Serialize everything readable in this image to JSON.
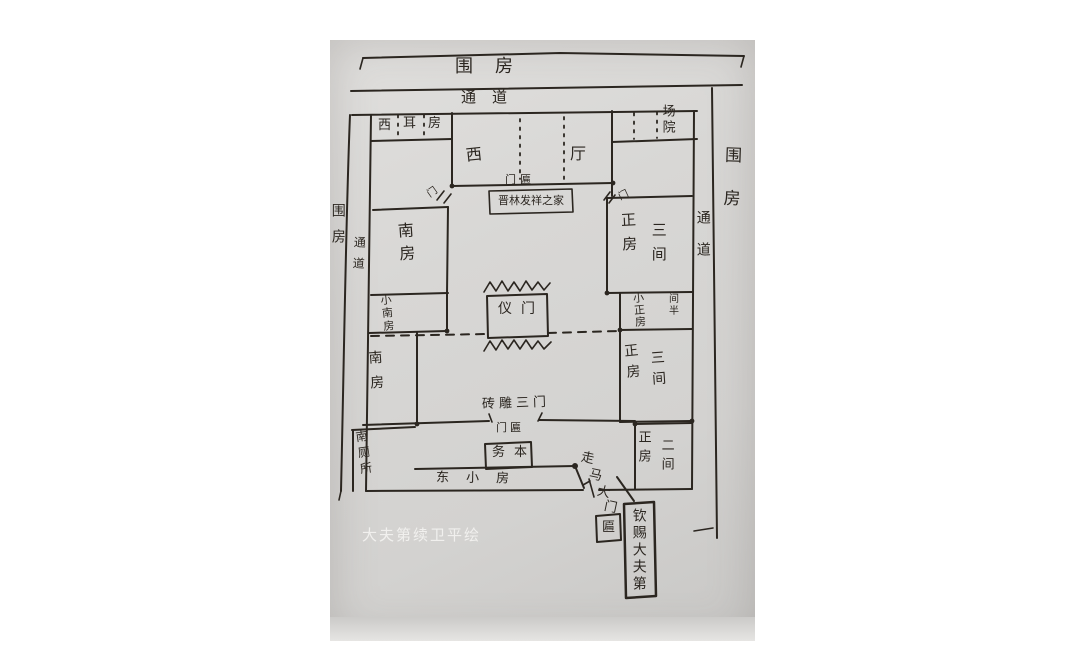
{
  "colors": {
    "ink": "#2b2620",
    "paper": "#d7d5d2",
    "watermark": "#f4f3f1"
  },
  "watermark": "大夫第续卫平绘",
  "outer": {
    "top_band": "围房",
    "top_passage": "通道",
    "left_band": "围房",
    "left_passage": "通道",
    "right_band": "围房",
    "right_passage": "通道"
  },
  "north_row": {
    "ear_rooms": [
      "西",
      "耳",
      "房"
    ],
    "hall": [
      "西",
      "厅"
    ],
    "hall_partition_label": "门匾",
    "hall_plaque": "晋林发祥之家",
    "yard": "场院",
    "left_door": "门",
    "right_door": "门"
  },
  "west_side": {
    "south_room_upper": "南房",
    "small_south_room": "小南房",
    "south_room_lower": "南房",
    "south_toilet": "南厕所"
  },
  "east_side": {
    "main_room_1": {
      "name": "正房",
      "bays": "三间"
    },
    "small_main_room": {
      "name": "小正房",
      "note": "间半"
    },
    "main_room_2": {
      "name": "正房",
      "bays": "三间"
    },
    "main_room_3": {
      "name": "正房",
      "bays": "二间"
    }
  },
  "center": {
    "ceremonial_gate": "仪门",
    "brick_gate": "砖雕三门",
    "gate_plaque_label": "门匾",
    "gate_plaque": "务本",
    "east_small_rooms": "东小房",
    "horse_gate": [
      "走",
      "马",
      "大",
      "门"
    ],
    "horse_gate_plaque": "匾",
    "imperial_plaque": "钦赐大夫第"
  }
}
